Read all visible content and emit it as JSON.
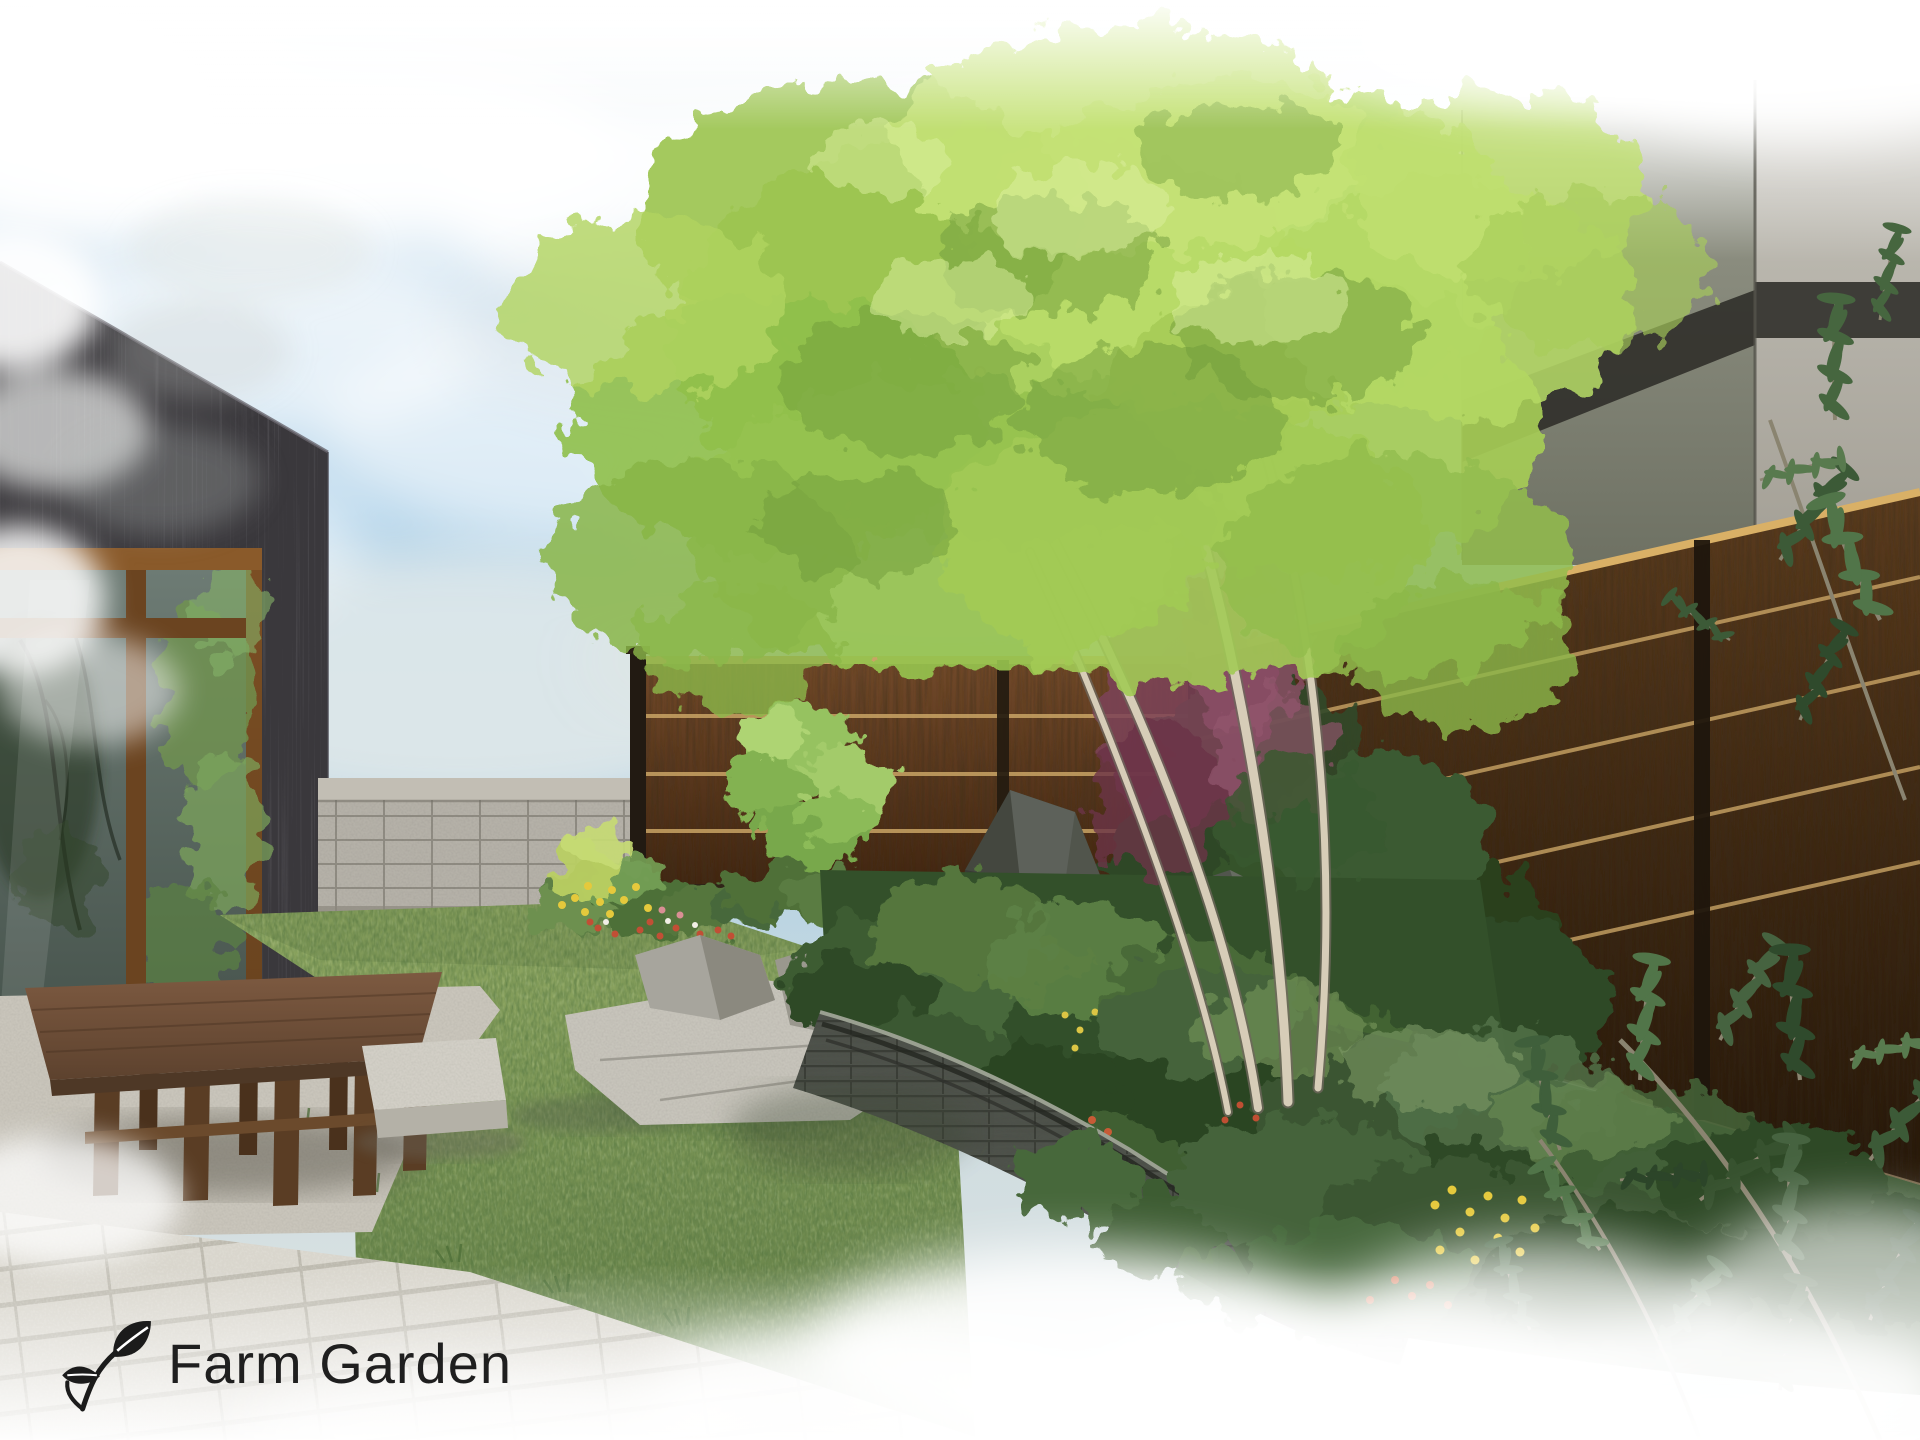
{
  "logo": {
    "text": "Farm Garden",
    "icon": "sprout-leaf-icon"
  },
  "scene_description": "Watercolor garden design rendering: dark-sided house with large window and wooden deck bench on the left, lawn, concrete block wall, brown wooden fences, stone lantern with rocks, curved stacked-stone raised planting bed, large light-green tree, gray building in the background and dense groundcover with yellow and red flowers",
  "colors": {
    "sky_blue": "#a9cfe8",
    "sky_horizon": "#dfe5e3",
    "cloud_white": "#ffffff",
    "house_wall": "#3a383c",
    "window_frame": "#7c4f24",
    "window_glass": "#57665f",
    "bench_wood": "#6e4e37",
    "block_wall": "#b5b1a8",
    "fence_wood": "#5e3d1f",
    "fence_stripe": "#c9a465",
    "fence_post": "#221a12",
    "lawn_light": "#8fa763",
    "lawn_dark": "#5e7a44",
    "foliage_bright": "#aed25e",
    "foliage_dark": "#3c5a31",
    "trunk_light": "#d7cdb8",
    "rock_light": "#a7a59d",
    "rock_dark": "#44473f",
    "lantern_stone": "#77736a",
    "bed_wall": "#4e524b",
    "paving": "#d9d6cd",
    "gravel": "#c9c5bb",
    "building_left": "#75786a",
    "building_right": "#a8a59c",
    "building_band": "#2d2c28",
    "purple_shrub": "#7c4257",
    "flower_yellow": "#e5c93c",
    "flower_red": "#c65b36",
    "logo_ink": "#1f1f1f"
  }
}
